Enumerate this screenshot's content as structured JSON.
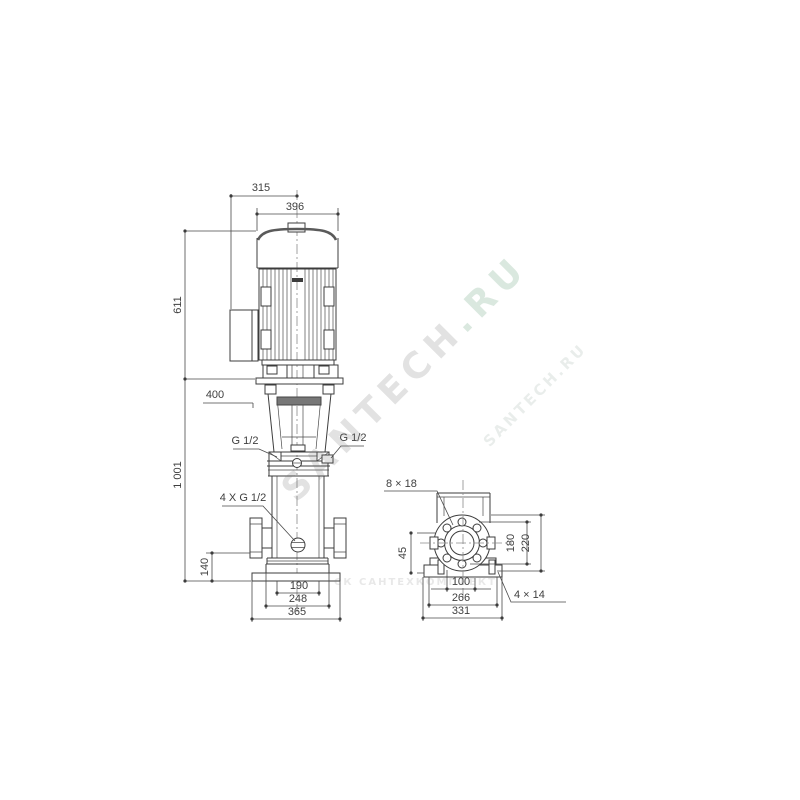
{
  "drawing": {
    "type": "technical dimensional drawing",
    "subject": "vertical multistage centrifugal pump, front view and side flange view",
    "line_color": "#3c3c3c",
    "text_color": "#3f3f3f",
    "background": "#ffffff"
  },
  "front_view": {
    "dim_315": "315",
    "dim_396": "396",
    "dim_611": "611",
    "dim_400": "400",
    "dim_1001": "1 001",
    "dim_140": "140",
    "dim_190": "190",
    "dim_248": "248",
    "dim_365": "365",
    "label_g12_left": "G 1/2",
    "label_g12_right": "G 1/2",
    "label_4xg12": "4 X G 1/2"
  },
  "side_view": {
    "label_8x18": "8 × 18",
    "dim_45": "45",
    "dim_180": "180",
    "dim_220": "220",
    "dim_100": "100",
    "dim_266": "266",
    "dim_331": "331",
    "label_4x14": "4 × 14"
  },
  "watermarks": {
    "diagonal_main_part1": "SANTECH",
    "diagonal_main_part2": ".RU",
    "diagonal_secondary": "SANTECH.RU",
    "horizontal": "СК САНТЕХКОМПЛЕКТ"
  }
}
